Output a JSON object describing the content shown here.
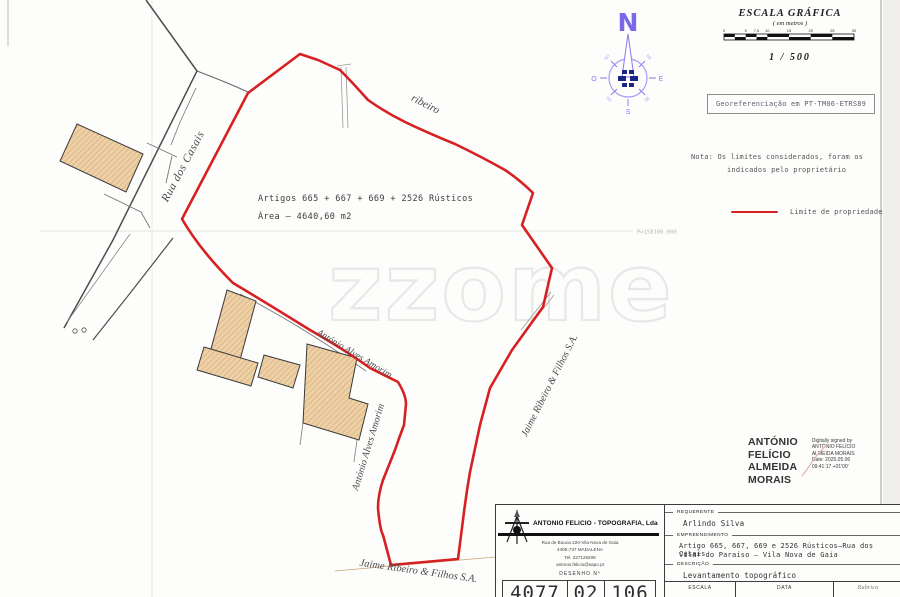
{
  "map": {
    "watermark": "zzome",
    "street_label": "Rua dos Casais",
    "stream_label": "ribeiro",
    "parcel": {
      "line1": "Artigos  665 + 667 + 669 + 2526 Rústicos",
      "line2": "Área – 4640,60 m2"
    },
    "neighbors": {
      "amorim_curve": "António Alves Amorim",
      "amorim_vertical": "António Alves Amorim",
      "jaime_vertical": "Jaime Ribeiro & Filhos S.A.",
      "jaime_bottom": "Jaime Ribeiro & Filhos S.A."
    },
    "grid_label_p": "P=158100.000"
  },
  "compass": {
    "n": "N",
    "e": "E",
    "s": "S",
    "o": "O",
    "ne": "NE",
    "no": "NO",
    "se": "SE",
    "so": "SO"
  },
  "scale_bar": {
    "title": "ESCALA GRÁFICA",
    "subtitle": "( em metros )",
    "ratio": "1 / 500",
    "ticks": [
      "0",
      "5",
      "7,5",
      "10",
      "15",
      "20",
      "25",
      "30"
    ]
  },
  "georef": {
    "label": "Georeferenciação em PT-TM06-ETRS89"
  },
  "note": {
    "line1": "Nota: Os limites considerados, foram os",
    "line2": "indicados pelo proprietário"
  },
  "legend": {
    "label": "Limite de propriedade",
    "color": "#d62021"
  },
  "signature": {
    "name_lines": [
      "ANTÓNIO",
      "FELÍCIO",
      "ALMEIDA",
      "MORAIS"
    ],
    "detail_lines": [
      "Digitally signed by",
      "ANTÓNIO FELÍCIO",
      "ALMEIDA MORAIS",
      "Date: 2025.05.06",
      "09:41:17 +01'00'"
    ]
  },
  "title_block": {
    "company_name": "ANTONIO FELICIO - TOPOGRAFIA, Lda",
    "address_lines": [
      "Rua de Bouca-220-Vila Nova de Gaia",
      "4405-737 MADALENA",
      "Tel.  227128208",
      "antonio.felicio@sapo.pt"
    ],
    "desenho_label": "DESENHO  Nº",
    "drawing_number": [
      "4077",
      "02",
      "106"
    ],
    "requerente_label": "REQUERENTE",
    "requerente_value": "Arlindo Silva",
    "empreendimento_label": "EMPREENDIMENTO",
    "empreendimento_line1": "Artigo 665, 667, 669 e 2526 Rústicos–Rua dos Casais",
    "empreendimento_line2": "Vilar do Paraíso – Vila Nova de Gaia",
    "descricao_label": "DESCRIÇÃO",
    "descricao_value": "Levantamento  topográfico",
    "escala_label": "ESCALA",
    "data_label": "DATA",
    "rubrica_label": "Rubrica"
  },
  "colors": {
    "boundary": "#d62021",
    "building_fill": "#eed0a6",
    "compass_accent": "#7a68ea"
  }
}
